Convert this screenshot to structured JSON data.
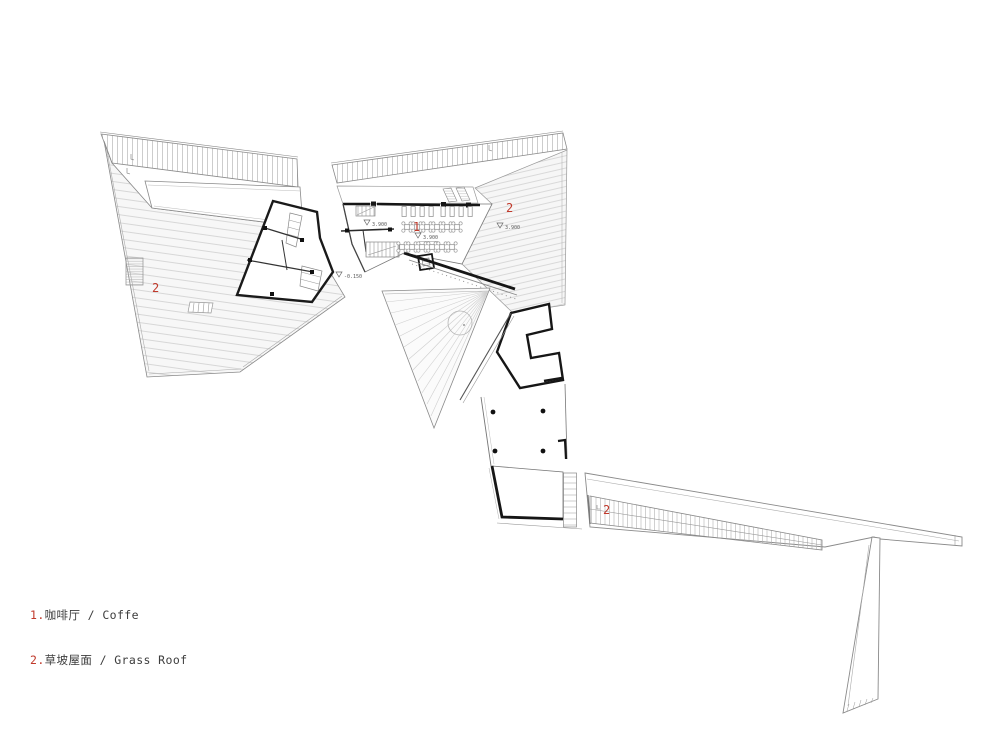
{
  "drawing": {
    "kind": "roof / floor plan line drawing",
    "background": "#ffffff"
  },
  "colors": {
    "accent_red": "#c0392b",
    "wall_dark": "#161616",
    "line_gray": "#8a8a8a",
    "hatch_gray": "#cdcdcd"
  },
  "legend": {
    "items": [
      {
        "num": "1.",
        "label": "咖啡厅 / Coffe"
      },
      {
        "num": "2.",
        "label": "草坡屋面 / Grass Roof"
      }
    ]
  },
  "labels": [
    {
      "id": "grass-roof-left",
      "text": "2"
    },
    {
      "id": "coffee-area",
      "text": "1"
    },
    {
      "id": "grass-roof-right",
      "text": "2"
    },
    {
      "id": "grass-roof-arm",
      "text": "2"
    }
  ],
  "elevations": [
    {
      "id": "cafe-left",
      "text": "3.900"
    },
    {
      "id": "cafe-floor",
      "text": "3.900"
    },
    {
      "id": "grass-right",
      "text": "3.900"
    },
    {
      "id": "gap-ground",
      "text": "-0.150"
    }
  ],
  "cafe": {
    "tables": {
      "row1": {
        "y": 227,
        "xs": [
          407,
          417,
          427,
          437,
          447,
          457
        ]
      },
      "row2": {
        "y": 247,
        "xs": [
          402,
          412,
          422,
          432,
          442,
          452
        ]
      }
    },
    "benches": {
      "y": 206.5,
      "w": 4.2,
      "h": 10,
      "xs": [
        402,
        411,
        420,
        429,
        441,
        450,
        459,
        468
      ]
    },
    "columns": {
      "r": 2.4,
      "pts": [
        [
          493,
          412
        ],
        [
          543,
          411
        ],
        [
          495,
          451
        ],
        [
          543,
          451
        ]
      ]
    }
  }
}
